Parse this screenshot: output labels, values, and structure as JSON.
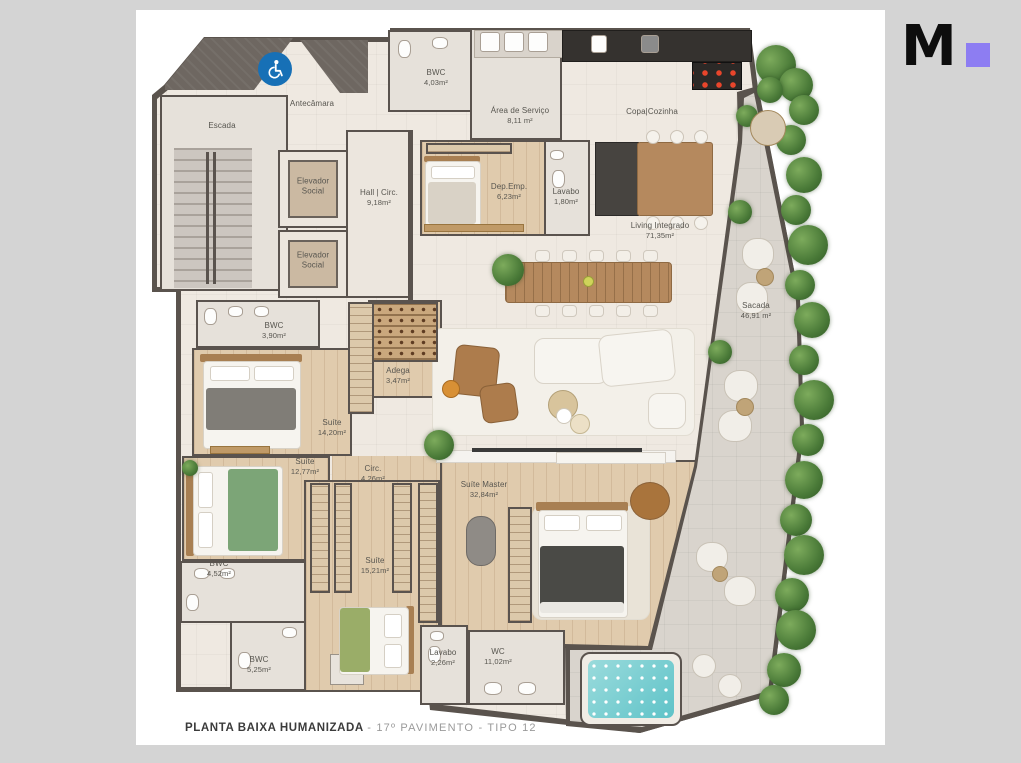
{
  "logo": {
    "letter": "M",
    "accent_color": "#8d7df2"
  },
  "caption": {
    "title": "PLANTA BAIXA HUMANIZADA",
    "subtitle": "- 17º PAVIMENTO - TIPO 12"
  },
  "colors": {
    "background": "#d4d4d4",
    "card": "#ffffff",
    "walls": "#5a534d",
    "floor_common": "#efe9e1",
    "floor_wood": "#e0cbad",
    "balcony": "#d9d4cd",
    "accessibility_blue": "#1770b6",
    "jacuzzi_teal": "#5fc3c8",
    "greenery": "#4a7a38"
  },
  "rooms": {
    "escada": {
      "name": "Escada",
      "area": ""
    },
    "antecamara": {
      "name": "Antecâmara",
      "area": ""
    },
    "elevador_social_1": {
      "name": "Elevador Social",
      "area": ""
    },
    "elevador_social_2": {
      "name": "Elevador Social",
      "area": ""
    },
    "hall_circ": {
      "name": "Hall | Circ.",
      "area": "9,18m²"
    },
    "bwc_403": {
      "name": "BWC",
      "area": "4,03m²"
    },
    "area_servico": {
      "name": "Área de Serviço",
      "area": "8,11 m²"
    },
    "copa_cozinha": {
      "name": "Copa|Cozinha",
      "area": ""
    },
    "dep_emp": {
      "name": "Dep.Emp.",
      "area": "6,23m²"
    },
    "lavabo_180": {
      "name": "Lavabo",
      "area": "1,80m²"
    },
    "living_integrado": {
      "name": "Living Integrado",
      "area": "71,35m²"
    },
    "sacada": {
      "name": "Sacada",
      "area": "46,91 m²"
    },
    "bwc_390": {
      "name": "BWC",
      "area": "3,90m²"
    },
    "adega": {
      "name": "Adega",
      "area": "3,47m²"
    },
    "suite_1420": {
      "name": "Suíte",
      "area": "14,20m²"
    },
    "suite_1277": {
      "name": "Suíte",
      "area": "12,77m²"
    },
    "circ": {
      "name": "Circ.",
      "area": "4,26m²"
    },
    "bwc_452": {
      "name": "BWC",
      "area": "4,52m²"
    },
    "suite_1521": {
      "name": "Suíte",
      "area": "15,21m²"
    },
    "bwc_525": {
      "name": "BWC",
      "area": "5,25m²"
    },
    "lavabo_226": {
      "name": "Lavabo",
      "area": "2,26m²"
    },
    "wc_1102": {
      "name": "WC",
      "area": "11,02m²"
    },
    "suite_master": {
      "name": "Suíte Master",
      "area": "32,84m²"
    }
  }
}
